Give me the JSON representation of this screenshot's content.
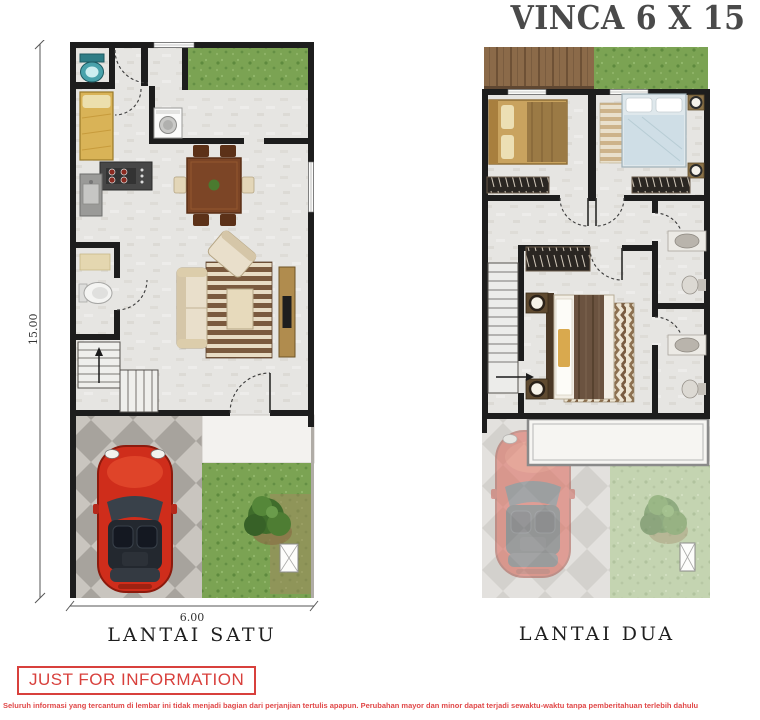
{
  "title": "VINCA 6 X 15",
  "plans": {
    "first": {
      "label": "LANTAI SATU",
      "dim_width": "6.00",
      "dim_height": "15.00",
      "features": [
        "toilet",
        "single-bed",
        "washing-machine",
        "kitchen-stove",
        "kitchen-sink",
        "dining-table",
        "powder-room-toilet",
        "sofa-set",
        "striped-rug",
        "tv-console",
        "stairs-up",
        "front-door",
        "red-car",
        "carport",
        "garden-tree",
        "back-garden"
      ]
    },
    "second": {
      "label": "LANTAI DUA",
      "features": [
        "wood-deck",
        "roof-garden",
        "wood-bed",
        "blue-bed",
        "wardrobe",
        "master-bed",
        "chevron-rug",
        "bedside-lamps",
        "stairs-down",
        "bathroom-sink",
        "bathroom-toilet",
        "carport-canopy",
        "faded-red-car",
        "garden-tree"
      ]
    }
  },
  "footer": {
    "stamp": "JUST FOR INFORMATION",
    "disclaimer": "Seluruh informasi yang tercantum di lembar ini tidak menjadi bagian dari perjanjian tertulis apapun. Perubahan mayor dan minor dapat terjadi sewaktu-waktu tanpa pemberitahuan terlebih dahulu"
  },
  "colors": {
    "title": "#4a4a4a",
    "accent_red": "#d8403c",
    "wall": "#1d1d1d",
    "floor": "#e6e5e2",
    "grass": "#7ba353",
    "carport_tile": "#c9c5bf",
    "car": "#cf2d1b",
    "wood_deck": "#8b6a49",
    "dining_wood": "#7c4526"
  }
}
